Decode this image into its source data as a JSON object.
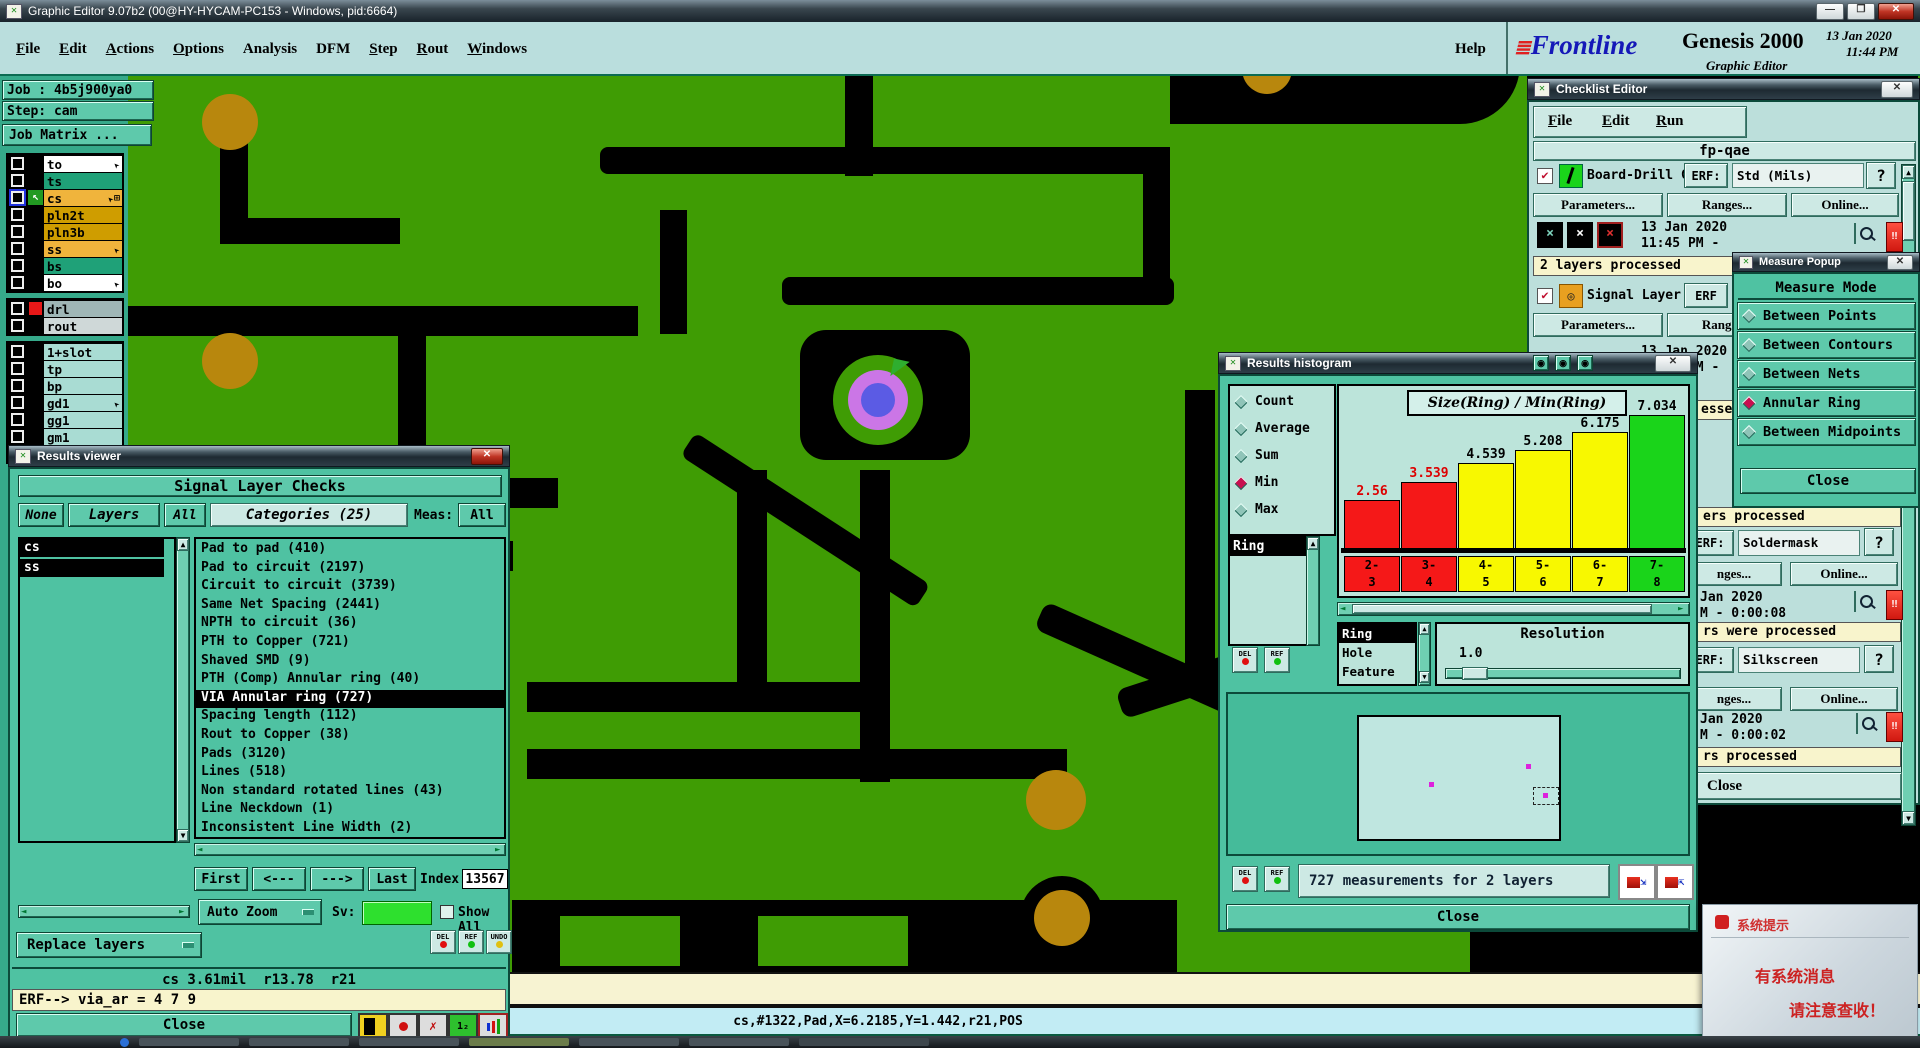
{
  "window": {
    "title": "Graphic Editor 9.07b2 (00@HY-HYCAM-PC153 - Windows, pid:6664)",
    "minimize": "—",
    "maximize": "❐",
    "close": "✕"
  },
  "menu": {
    "items": [
      "File",
      "Edit",
      "Actions",
      "Options",
      "Analysis",
      "DFM",
      "Step",
      "Rout",
      "Windows"
    ],
    "help": "Help"
  },
  "brand": {
    "prefix": "≣",
    "logo": "Frontline",
    "product": "Genesis 2000",
    "date": "13 Jan 2020",
    "time": "11:44 PM",
    "subtitle": "Graphic Editor"
  },
  "sidebar": {
    "job": "Job : 4b5j900ya0",
    "step": "Step: cam",
    "job_matrix": "Job Matrix ...",
    "layer_groups": [
      [
        {
          "name": "to",
          "color": "#ffffff",
          "arrow": true
        },
        {
          "name": "ts",
          "color": "#1fa178"
        },
        {
          "name": "cs",
          "color": "#f0b43c",
          "arrow": true,
          "grid": true,
          "selected": true
        },
        {
          "name": "pln2t",
          "color": "#cf9d00"
        },
        {
          "name": "pln3b",
          "color": "#cf9d00"
        },
        {
          "name": "ss",
          "color": "#f0b43c",
          "arrow": true
        },
        {
          "name": "bs",
          "color": "#1fa178"
        },
        {
          "name": "bo",
          "color": "#ffffff",
          "arrow": true
        }
      ],
      [
        {
          "name": "drl",
          "color": "#9fb6b6",
          "chip": true
        },
        {
          "name": "rout",
          "color": "#cfd8d8"
        }
      ],
      [
        {
          "name": "1+slot",
          "color": "#a9dcd3"
        },
        {
          "name": "tp",
          "color": "#a9dcd3"
        },
        {
          "name": "bp",
          "color": "#a9dcd3"
        },
        {
          "name": "gd1",
          "color": "#a9dcd3",
          "arrow": true
        },
        {
          "name": "gg1",
          "color": "#a9dcd3"
        },
        {
          "name": "gm1",
          "color": "#a9dcd3"
        },
        {
          "name": "gm10",
          "color": "#a9dcd3"
        }
      ]
    ]
  },
  "results_viewer": {
    "title": "Results viewer",
    "header": "Signal Layer Checks",
    "filters": [
      "None",
      "Layers",
      "All"
    ],
    "categories_header": "Categories (25)",
    "meas_label": "Meas:",
    "meas_value": "All",
    "layer_list": [
      "cs",
      "ss"
    ],
    "categories": [
      {
        "label": "Pad to pad (410)"
      },
      {
        "label": "Pad to circuit (2197)"
      },
      {
        "label": "Circuit to circuit (3739)"
      },
      {
        "label": "Same Net Spacing (2441)"
      },
      {
        "label": "NPTH to circuit (36)"
      },
      {
        "label": "PTH to Copper (721)"
      },
      {
        "label": "Shaved SMD (9)"
      },
      {
        "label": "PTH (Comp) Annular ring (40)"
      },
      {
        "label": "VIA Annular ring (727)",
        "selected": true
      },
      {
        "label": "Spacing length (112)"
      },
      {
        "label": "Rout to Copper (38)"
      },
      {
        "label": "Pads (3120)"
      },
      {
        "label": "Lines (518)"
      },
      {
        "label": "Non standard rotated lines (43)"
      },
      {
        "label": "Line Neckdown (1)"
      },
      {
        "label": "Inconsistent Line Width (2)"
      }
    ],
    "nav": {
      "first": "First",
      "prev": "<---",
      "next": "--->",
      "last": "Last",
      "index_label": "Index:",
      "index_value": "13567"
    },
    "auto_zoom": "Auto Zoom",
    "sv_label": "Sv:",
    "show_all_label": "Show All",
    "mini_buttons": [
      "DEL",
      "REF",
      "UNDO"
    ],
    "replace_layers": "Replace layers",
    "status": "cs 3.61mil  r13.78  r21",
    "erf_line": "ERF--> via_ar = 4 7 9",
    "close": "Close"
  },
  "histogram": {
    "title": "Results histogram",
    "stats": [
      {
        "label": "Count"
      },
      {
        "label": "Average"
      },
      {
        "label": "Sum"
      },
      {
        "label": "Min",
        "selected": true
      },
      {
        "label": "Max"
      }
    ],
    "series_list": [
      "Ring"
    ],
    "feature_list": [
      {
        "label": "Ring",
        "selected": true
      },
      {
        "label": "Hole"
      },
      {
        "label": "Feature"
      }
    ],
    "chart_data": {
      "type": "bar",
      "title": "Size(Ring) / Min(Ring)",
      "categories": [
        "2-3",
        "3-4",
        "4-5",
        "5-6",
        "6-7",
        "7-8"
      ],
      "values": [
        2.56,
        3.539,
        4.539,
        5.208,
        6.175,
        7.034
      ],
      "labels": [
        "2.56",
        "3.539",
        "4.539",
        "5.208",
        "6.175",
        "7.034"
      ],
      "colors": [
        "#f51818",
        "#f51818",
        "#f8f800",
        "#f8f800",
        "#f8f800",
        "#1ad41a"
      ],
      "label_colors": [
        "#dd0000",
        "#dd0000",
        "#000000",
        "#000000",
        "#000000",
        "#000000"
      ],
      "xlabel": "",
      "ylabel": "",
      "ylim": [
        0,
        7.5
      ],
      "legend": "none",
      "grid": false
    },
    "resolution_label": "Resolution",
    "resolution_value": "1.0",
    "del": "DEL",
    "ref": "REF",
    "measurements": "727 measurements for 2 layers",
    "close": "Close"
  },
  "checklist": {
    "title": "Checklist Editor",
    "menu": [
      "File",
      "Edit",
      "Run"
    ],
    "header": "fp-qae",
    "item1": {
      "label": "Board-Drill Che",
      "erf_label": "ERF:",
      "erf_value": "Std (Mils)",
      "help": "?",
      "btn_parameters": "Parameters...",
      "btn_ranges": "Ranges...",
      "btn_online": "Online...",
      "date": "13 Jan 2020",
      "time": "11:45 PM -",
      "status": "2 layers processed"
    },
    "item2": {
      "label": "Signal Layer Ch",
      "erf_label": "ERF",
      "btn_parameters": "Parameters...",
      "btn_ranges": "Ranges...",
      "date": "13 Jan 2020",
      "time": "11:45 PM -",
      "status_fragment": "essed"
    },
    "item3": {
      "status_above": "ers processed",
      "erf_label": "ERF:",
      "erf_value": "Soldermask",
      "help": "?",
      "btn_ranges_fragment": "nges...",
      "btn_online": "Online...",
      "date_fragment": "Jan 2020",
      "time_fragment": "M - 0:00:08",
      "status": "rs were processed"
    },
    "item4": {
      "erf_label": "ERF:",
      "erf_value": "Silkscreen",
      "help": "?",
      "btn_ranges_fragment": "nges...",
      "btn_online": "Online...",
      "date_fragment": "Jan 2020",
      "time_fragment": "M - 0:00:02",
      "status": "rs processed"
    },
    "close": "Close"
  },
  "measure_popup": {
    "title": "Measure Popup",
    "header": "Measure Mode",
    "options": [
      {
        "label": "Between Points"
      },
      {
        "label": "Between Contours"
      },
      {
        "label": "Between Nets"
      },
      {
        "label": "Annular Ring",
        "selected": true
      },
      {
        "label": "Between Midpoints"
      }
    ],
    "close": "Close"
  },
  "status_bar": {
    "log_fragment": "ner",
    "readout": "cs,#1322,Pad,X=6.2185,Y=1.442,r21,POS"
  },
  "system_popup": {
    "title": "系统提示",
    "line1": "有系统消息",
    "line2": "请注意查收！"
  },
  "colors": {
    "pcb_green": "#3f9c04",
    "gold": "#b8870d",
    "teal_panel": "#4fc2a2",
    "pale_panel": "#bcdfdb",
    "via_ring": "#cb76e6",
    "via_center": "#5b5be4",
    "bar_red": "#f51818",
    "bar_yellow": "#f8f800",
    "bar_green": "#1ad41a",
    "status_yellow": "#f8f4cc"
  }
}
